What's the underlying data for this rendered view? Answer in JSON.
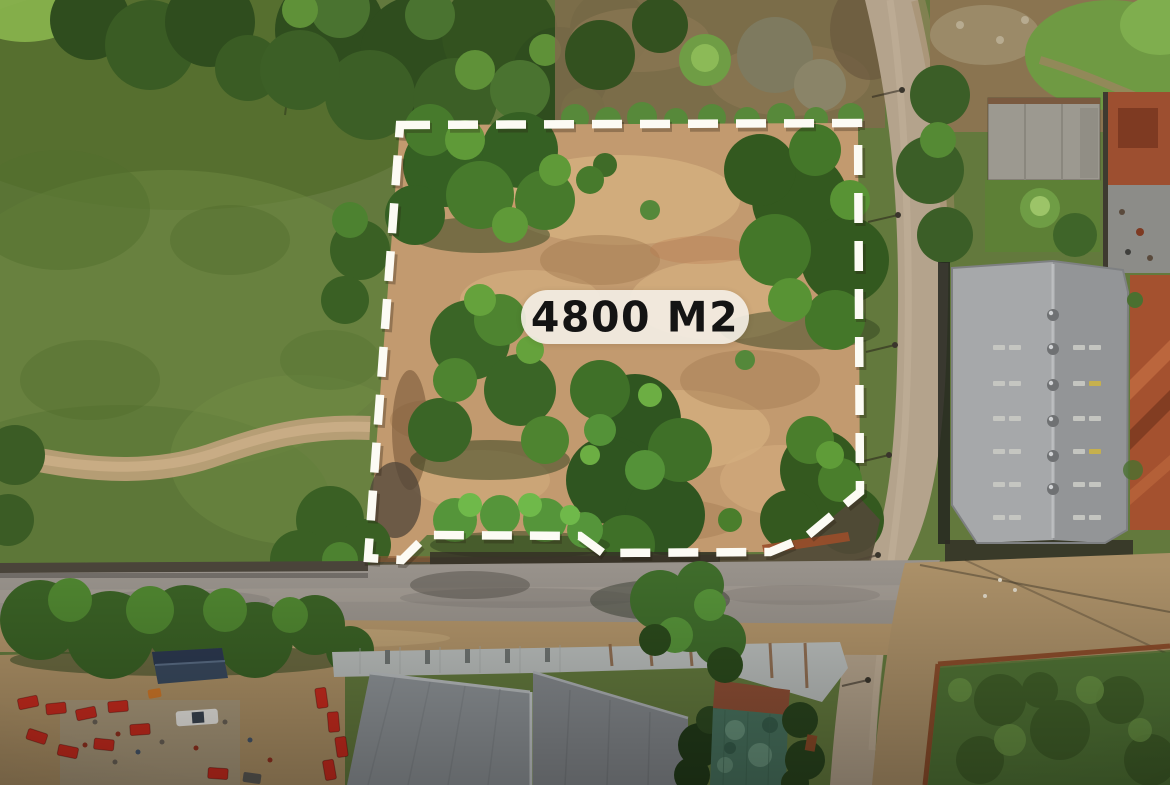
{
  "overlay": {
    "area_label": "4800 M2"
  },
  "colors": {
    "boundary_dash": "#fcfbf4",
    "label_background": "#f3eee4",
    "label_text": "#141414",
    "parcel_dirt": "#c29a6f",
    "field_green": "#63793d",
    "road_gray": "#98928b",
    "warehouse_roof": "#9da0a2",
    "tile_roof": "#a4512f",
    "machinery_red": "#c92b1e",
    "court_teal": "#49735f"
  }
}
